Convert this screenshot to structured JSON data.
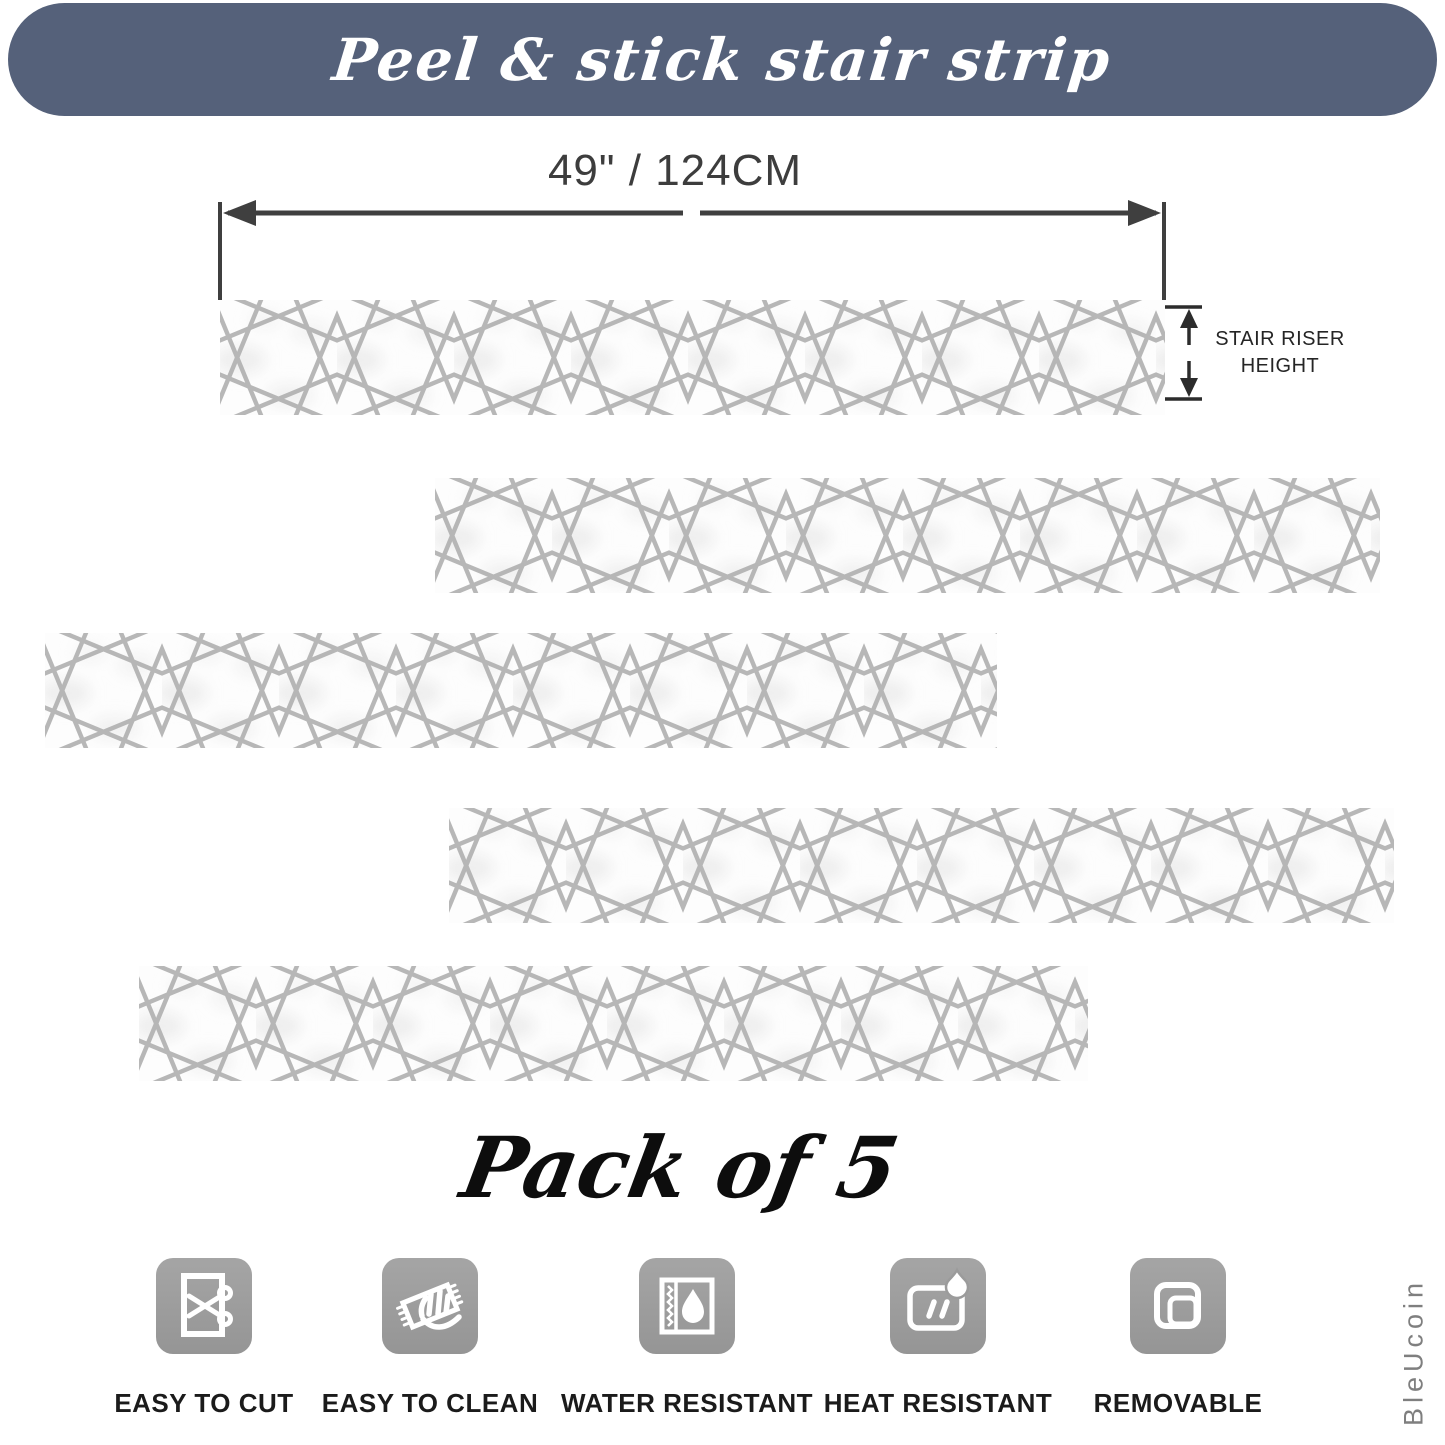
{
  "banner": {
    "title": "Peel & stick stair strip",
    "bg_color": "#55617a",
    "text_color": "#ffffff"
  },
  "dimension": {
    "width_label": "49\" / 124CM",
    "riser_label_line1": "STAIR RISER",
    "riser_label_line2": "HEIGHT",
    "arrow_color": "#3f3f3f"
  },
  "strips": {
    "count": 5,
    "pattern": "moroccan-eight-point-star",
    "line_color": "#b1b1b1",
    "background": "#fdfdfd"
  },
  "pack": {
    "label": "Pack of 5"
  },
  "features": [
    {
      "icon": "scissors-icon",
      "label": "EASY TO CUT"
    },
    {
      "icon": "wipe-clean-icon",
      "label": "EASY TO CLEAN"
    },
    {
      "icon": "water-drop-icon",
      "label": "WATER RESISTANT"
    },
    {
      "icon": "flame-icon",
      "label": "HEAT RESISTANT"
    },
    {
      "icon": "peel-layers-icon",
      "label": "REMOVABLE"
    }
  ],
  "brand": {
    "name": "BleUcoin",
    "color": "#7f7f7f"
  },
  "colors": {
    "icon_tile": "#9d9d9d",
    "label_text": "#1b1b1b",
    "dim_text": "#3d3d3d"
  }
}
